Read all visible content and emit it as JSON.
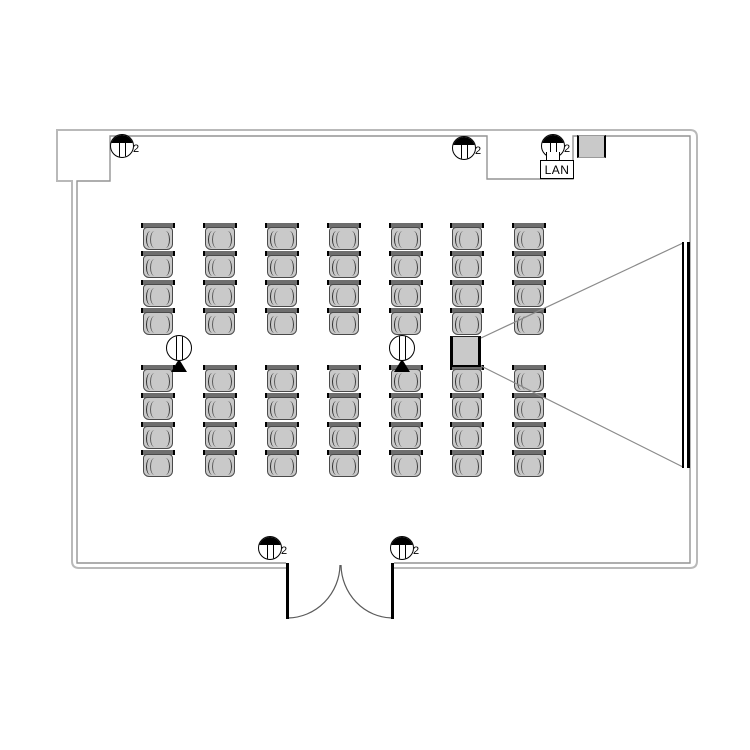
{
  "page": {
    "background": "#ffffff"
  },
  "floorplan": {
    "kind": "seminar-room-floor-plan",
    "colors": {
      "chair_seat": "#c9c9c9",
      "chair_back": "#6e6e6e",
      "wall_outer": "#b9b9b9",
      "wall_inner": "#949494",
      "symbol_line": "#000000",
      "projection_line": "#8a8a8a"
    },
    "seating": {
      "columns_x": [
        143,
        205,
        267,
        329,
        391,
        452,
        514
      ],
      "rows_y": [
        223,
        251,
        280,
        308,
        365,
        393,
        422,
        450
      ],
      "chair_width": 30,
      "chair_height": 28,
      "total_chairs": 56
    },
    "wall_outlets": [
      {
        "x": 122,
        "y": 146,
        "label": "2"
      },
      {
        "x": 464,
        "y": 148,
        "label": "2"
      },
      {
        "x": 553,
        "y": 146,
        "label": "2"
      },
      {
        "x": 270,
        "y": 548,
        "label": "2"
      },
      {
        "x": 402,
        "y": 548,
        "label": "2"
      }
    ],
    "floor_outlets": [
      {
        "x": 179,
        "y": 348
      },
      {
        "x": 402,
        "y": 348
      }
    ],
    "projector": {
      "x": 450,
      "y": 336,
      "w": 31,
      "h": 31
    },
    "screen": {
      "x": 682,
      "y": 242,
      "w": 8,
      "h": 226
    },
    "equipment_box": {
      "x": 577,
      "y": 135,
      "w": 29,
      "h": 23
    },
    "lan_outlet": {
      "x": 540,
      "y": 160,
      "w": 34,
      "h": 19,
      "label": "LAN"
    },
    "door": {
      "opening_left_x": 287,
      "opening_right_x": 392,
      "wall_y": 563,
      "type": "double-outward"
    }
  }
}
